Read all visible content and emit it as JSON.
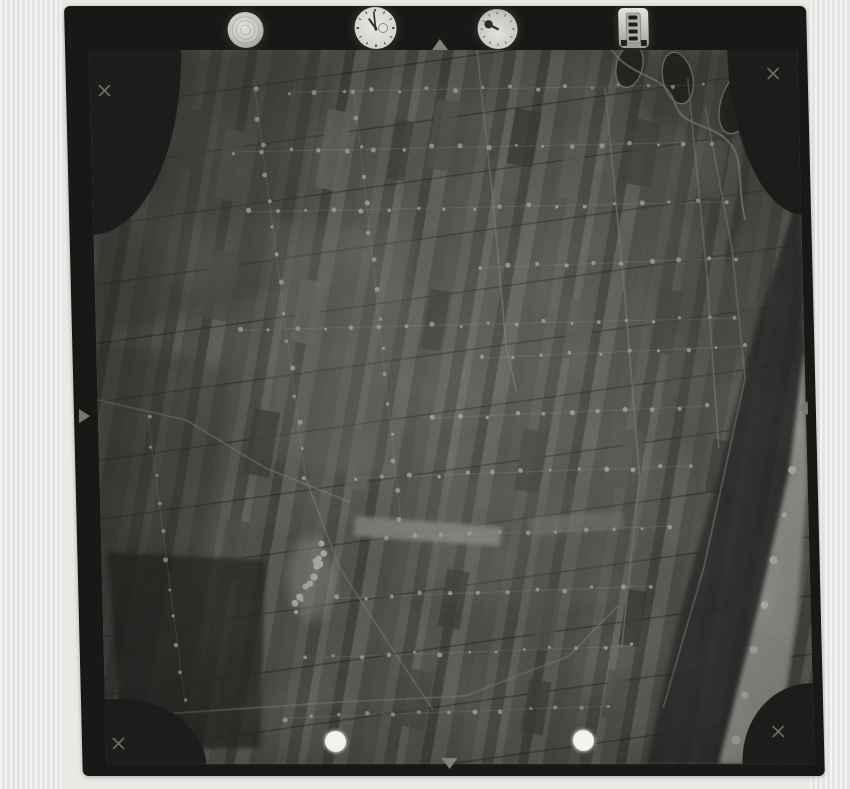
{
  "image": {
    "kind": "scanned vertical aerial survey photograph",
    "alt": "Black-and-white aerial photo of coastal strip-field farmland with dune belt and beach along the right edge; instrument dials recorded on the film margin at top"
  },
  "scanner": {
    "bg": "#ebe9e6"
  },
  "film": {
    "frame_color": "#181816",
    "photo_base": "#757570"
  },
  "instruments": {
    "level": {
      "name": "spherical level",
      "rings": 3
    },
    "clock": {
      "name": "clock",
      "ticks": 12,
      "hour_angle": -35,
      "minute_angle": -5,
      "subdial_dx": 7.5,
      "subdial_r": 4.5
    },
    "altimeter": {
      "name": "altimeter",
      "ticks": 12,
      "needle_angle": -62
    },
    "counter": {
      "name": "frame counter",
      "mark_rows": 4
    }
  },
  "fiducials": {
    "crosses": [
      {
        "x": 14,
        "y": 40
      },
      {
        "x": 683,
        "y": 23
      },
      {
        "x": 12,
        "y": 693
      },
      {
        "x": 672,
        "y": 681
      }
    ],
    "cross_color": "#73736d"
  },
  "punch_holes": [
    {
      "x": 229,
      "y": 691,
      "d": 21
    },
    {
      "x": 477,
      "y": 690,
      "d": 21
    }
  ],
  "photo": {
    "w": 708,
    "h": 714,
    "strip_pattern": {
      "tile_w": 96,
      "tile_h": 40,
      "angle": 11,
      "opacity": 0.7,
      "strips": [
        [
          0,
          14,
          "#6b6b66"
        ],
        [
          14,
          10,
          "#7c7c77"
        ],
        [
          24,
          12,
          "#5c5c57"
        ],
        [
          36,
          8,
          "#8b8b85"
        ],
        [
          44,
          16,
          "#70706b"
        ],
        [
          60,
          10,
          "#50504b"
        ],
        [
          70,
          14,
          "#83837d"
        ],
        [
          84,
          12,
          "#64645f"
        ]
      ]
    },
    "row_lines": {
      "gap": 58,
      "angle": -8,
      "color": "rgba(24,24,21,0.38)",
      "width": 1.4
    },
    "regions_soft": [
      {
        "pts": "0,0 250,0 188,238 0,288",
        "fill": "#53534e",
        "op": 0.5
      },
      {
        "pts": "0,288 132,318 82,714 0,714",
        "fill": "#4b4b46",
        "op": 0.45
      },
      {
        "pts": "516,0 708,0 708,128 556,68",
        "fill": "#54544e",
        "op": 0.5
      },
      {
        "pts": "556,78 708,128 652,298 594,418 552,298",
        "fill": "#5d5d57",
        "op": 0.38
      },
      {
        "pts": "176,168 326,182 296,428 166,408",
        "fill": "#8f8f89",
        "op": 0.3
      },
      {
        "pts": "326,428 556,438 540,558 316,542",
        "fill": "#7f7f79",
        "op": 0.28
      }
    ],
    "regions_sharp": [
      {
        "pts": "6,502 164,510 154,698 16,700",
        "fill": "#3a3a36",
        "op": 0.78
      },
      {
        "pts": "255,466 402,477 398,496 253,486",
        "fill": "#aeaea8",
        "op": 0.9
      },
      {
        "pts": "426,468 522,461 525,478 430,486",
        "fill": "#9c9c96",
        "op": 0.55
      }
    ],
    "patches": [
      [
        90,
        60,
        26,
        60,
        "#5e5e58"
      ],
      [
        128,
        80,
        20,
        70,
        "#6e6e68"
      ],
      [
        230,
        60,
        24,
        80,
        "#87877f"
      ],
      [
        300,
        70,
        18,
        60,
        "#565650"
      ],
      [
        340,
        50,
        22,
        70,
        "#6a6a64"
      ],
      [
        420,
        60,
        26,
        56,
        "#4f4f49"
      ],
      [
        470,
        90,
        20,
        60,
        "#7c7c74"
      ],
      [
        540,
        70,
        24,
        66,
        "#5a5a54"
      ],
      [
        610,
        90,
        22,
        58,
        "#6f6f67"
      ],
      [
        110,
        200,
        30,
        70,
        "#63635d"
      ],
      [
        200,
        230,
        24,
        64,
        "#8a8a82"
      ],
      [
        330,
        240,
        20,
        60,
        "#52524c"
      ],
      [
        470,
        250,
        26,
        60,
        "#74746c"
      ],
      [
        560,
        240,
        22,
        64,
        "#5e5e56"
      ],
      [
        640,
        250,
        20,
        56,
        "#6a6a62"
      ],
      [
        150,
        360,
        26,
        66,
        "#57574f"
      ],
      [
        250,
        380,
        22,
        60,
        "#7d7d75"
      ],
      [
        420,
        380,
        24,
        62,
        "#5c5c54"
      ],
      [
        520,
        380,
        22,
        60,
        "#6d6d65"
      ],
      [
        610,
        390,
        20,
        54,
        "#555551"
      ],
      [
        120,
        470,
        24,
        60,
        "#6b6b63"
      ],
      [
        340,
        520,
        22,
        58,
        "#585850"
      ],
      [
        430,
        540,
        24,
        60,
        "#70706a"
      ],
      [
        520,
        540,
        20,
        56,
        "#505048"
      ],
      [
        300,
        620,
        24,
        58,
        "#646460"
      ],
      [
        420,
        630,
        22,
        54,
        "#585852"
      ],
      [
        500,
        620,
        20,
        50,
        "#6e6e66"
      ]
    ],
    "coast": {
      "dune_pts": "708,140 665,260 620,420 575,570 540,714 640,714 678,540 700,380 708,300",
      "dune_fill": "#3e3e3a",
      "beach_pts": "708,300 690,420 655,560 612,714 668,714 695,560 708,430",
      "beach_fill": "#c6c6c0",
      "surf": [
        [
          693,
          420
        ],
        [
          684,
          465
        ],
        [
          672,
          510
        ],
        [
          662,
          555
        ],
        [
          650,
          600
        ],
        [
          640,
          645
        ],
        [
          630,
          690
        ]
      ],
      "surf_fill": "#efefeb"
    },
    "river": {
      "path": "M520,-4 C540,30 575,22 584,52 C592,80 620,70 640,95 C652,110 645,140 652,170",
      "stroke": "#a9a9a3",
      "loops": [
        {
          "cx": 540,
          "cy": 16,
          "rx": 13,
          "ry": 22,
          "rot": 15
        },
        {
          "cx": 588,
          "cy": 28,
          "rx": 15,
          "ry": 26,
          "rot": -10
        },
        {
          "cx": 648,
          "cy": 52,
          "rx": 17,
          "ry": 33,
          "rot": 20
        }
      ],
      "loop_fill": "#33332f",
      "band": "M655,60 C660,120 642,170 632,212",
      "band_stroke": "#45453f"
    },
    "roads": [
      [
        28,
        666,
        235,
        652,
        360,
        646,
        465,
        606,
        515,
        556
      ],
      [
        615,
        58,
        638,
        198,
        648,
        328,
        602,
        518,
        558,
        658
      ],
      [
        388,
        0,
        400,
        148,
        410,
        298,
        419,
        342
      ],
      [
        0,
        350,
        88,
        370,
        166,
        418,
        250,
        452
      ],
      [
        206,
        428,
        238,
        518,
        288,
        598,
        328,
        660
      ],
      [
        515,
        38,
        530,
        248,
        540,
        428,
        518,
        598
      ],
      [
        598,
        28,
        612,
        218,
        620,
        398
      ]
    ],
    "road_color": "#a6a6a0",
    "farm_rows": [
      [
        198,
        42,
        612,
        35,
        16
      ],
      [
        142,
        102,
        622,
        92,
        18
      ],
      [
        157,
        162,
        632,
        152,
        18
      ],
      [
        386,
        218,
        642,
        208,
        10
      ],
      [
        146,
        280,
        640,
        268,
        19
      ],
      [
        386,
        308,
        650,
        296,
        10
      ],
      [
        336,
        368,
        610,
        356,
        11
      ],
      [
        255,
        428,
        590,
        416,
        13
      ],
      [
        284,
        488,
        570,
        476,
        11
      ],
      [
        233,
        548,
        548,
        536,
        12
      ],
      [
        202,
        608,
        528,
        596,
        13
      ],
      [
        180,
        668,
        505,
        656,
        13
      ],
      [
        165,
        40,
        206,
        428,
        15
      ],
      [
        264,
        40,
        300,
        468,
        16
      ],
      [
        50,
        368,
        80,
        652,
        11
      ]
    ],
    "farm_dot_color": "#d6d6d0",
    "village": {
      "x1": 224,
      "y1": 495,
      "x2": 195,
      "y2": 560,
      "blobs": 14,
      "blob_fill": "#e8e8e2",
      "halo_fill": "#c9c9c3"
    }
  }
}
